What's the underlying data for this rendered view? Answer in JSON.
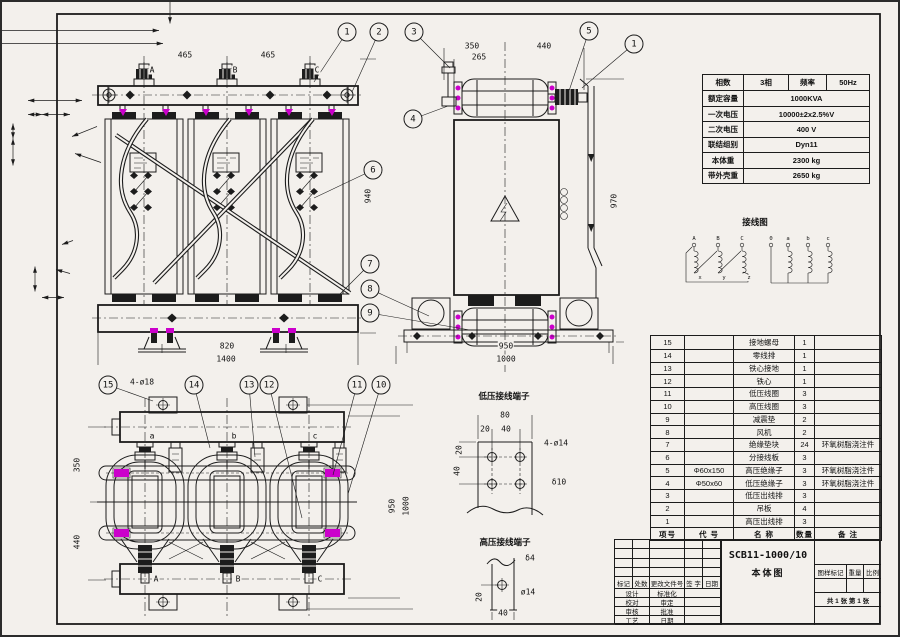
{
  "colors": {
    "paper": "#f3f0ec",
    "line": "#1c1c1c",
    "highlight_magenta": "#cb00cb"
  },
  "spec": {
    "row0": [
      "相数",
      "3相",
      "频率",
      "50Hz"
    ],
    "rows": [
      {
        "label": "额定容量",
        "value": "1000KVA"
      },
      {
        "label": "一次电压",
        "value": "10000±2x2.5%V"
      },
      {
        "label": "二次电压",
        "value": "400 V"
      },
      {
        "label": "联结组别",
        "value": "Dyn11"
      },
      {
        "label": "本体重",
        "value": "2300 kg"
      },
      {
        "label": "带外壳重",
        "value": "2650 kg"
      }
    ]
  },
  "parts": {
    "header": {
      "no": "项号",
      "code": "代 号",
      "name": "名 称",
      "qty": "数量",
      "remark": "备 注"
    },
    "rows": [
      {
        "no": "15",
        "code": "",
        "name": "接地螺母",
        "qty": "1",
        "remark": ""
      },
      {
        "no": "14",
        "code": "",
        "name": "零线排",
        "qty": "1",
        "remark": ""
      },
      {
        "no": "13",
        "code": "",
        "name": "铁心接地",
        "qty": "1",
        "remark": ""
      },
      {
        "no": "12",
        "code": "",
        "name": "铁心",
        "qty": "1",
        "remark": ""
      },
      {
        "no": "11",
        "code": "",
        "name": "低压线圈",
        "qty": "3",
        "remark": ""
      },
      {
        "no": "10",
        "code": "",
        "name": "高压线圈",
        "qty": "3",
        "remark": ""
      },
      {
        "no": "9",
        "code": "",
        "name": "减震垫",
        "qty": "2",
        "remark": ""
      },
      {
        "no": "8",
        "code": "",
        "name": "风机",
        "qty": "2",
        "remark": ""
      },
      {
        "no": "7",
        "code": "",
        "name": "绝缘垫块",
        "qty": "24",
        "remark": "环氧树脂浇注件"
      },
      {
        "no": "6",
        "code": "",
        "name": "分接线板",
        "qty": "3",
        "remark": ""
      },
      {
        "no": "5",
        "code": "Φ60x150",
        "name": "高压绝缘子",
        "qty": "3",
        "remark": "环氧树脂浇注件"
      },
      {
        "no": "4",
        "code": "Φ50x60",
        "name": "低压绝缘子",
        "qty": "3",
        "remark": "环氧树脂浇注件"
      },
      {
        "no": "3",
        "code": "",
        "name": "低压出线排",
        "qty": "3",
        "remark": ""
      },
      {
        "no": "2",
        "code": "",
        "name": "吊板",
        "qty": "4",
        "remark": ""
      },
      {
        "no": "1",
        "code": "",
        "name": "高压出线排",
        "qty": "3",
        "remark": ""
      }
    ]
  },
  "tb": {
    "product": "SCB11-1000/10",
    "drawing_name": "本体图",
    "cols": {
      "mark": "标记",
      "count": "处数",
      "doc": "更改文件号",
      "sign": "签 字",
      "date": "日期"
    },
    "left_rows": [
      [
        "设计",
        "标准化"
      ],
      [
        "校对",
        "审定"
      ],
      [
        "审核",
        "批准"
      ],
      [
        "工艺",
        "日期"
      ]
    ],
    "right": {
      "stamp": "图样标记",
      "weight": "重量",
      "scale": "比例",
      "sheets": "共 1 张 第 1 张"
    }
  },
  "wiring": {
    "title": "接线图",
    "hv_terminals": [
      "A",
      "B",
      "C"
    ],
    "hv_ends": [
      "x",
      "y",
      "z"
    ],
    "lv_terminals": [
      "0",
      "a",
      "b",
      "c"
    ]
  },
  "annotations": {
    "titles": [
      {
        "t": "低压接线端子",
        "x": 502,
        "y": 394,
        "cls": "cn",
        "n": "lv-terminal-detail-title"
      },
      {
        "t": "高压接线端子",
        "x": 503,
        "y": 540,
        "cls": "cn",
        "n": "hv-terminal-detail-title"
      },
      {
        "t": "接线图",
        "x": 753,
        "y": 220,
        "cls": "cn",
        "n": "wiring-diagram-title"
      }
    ],
    "dims": [
      {
        "t": "465",
        "x": 183,
        "y": 53
      },
      {
        "t": "465",
        "x": 266,
        "y": 53
      },
      {
        "t": "A",
        "x": 150,
        "y": 68
      },
      {
        "t": "B",
        "x": 233,
        "y": 68
      },
      {
        "t": "C",
        "x": 315,
        "y": 68
      },
      {
        "t": "820",
        "x": 225,
        "y": 344
      },
      {
        "t": "1400",
        "x": 224,
        "y": 357
      },
      {
        "t": "940",
        "x": 366,
        "y": 194,
        "r": 1
      },
      {
        "t": "350",
        "x": 470,
        "y": 44
      },
      {
        "t": "440",
        "x": 542,
        "y": 44
      },
      {
        "t": "265",
        "x": 477,
        "y": 55
      },
      {
        "t": "950",
        "x": 504,
        "y": 344
      },
      {
        "t": "1000",
        "x": 504,
        "y": 357
      },
      {
        "t": "970",
        "x": 612,
        "y": 199,
        "r": 1
      },
      {
        "t": "4-ø18",
        "x": 140,
        "y": 380
      },
      {
        "t": "a",
        "x": 150,
        "y": 434
      },
      {
        "t": "b",
        "x": 232,
        "y": 434
      },
      {
        "t": "c",
        "x": 313,
        "y": 434
      },
      {
        "t": "A",
        "x": 154,
        "y": 577
      },
      {
        "t": "B",
        "x": 236,
        "y": 577
      },
      {
        "t": "C",
        "x": 318,
        "y": 577
      },
      {
        "t": "350",
        "x": 75,
        "y": 463,
        "r": 1
      },
      {
        "t": "440",
        "x": 75,
        "y": 540,
        "r": 1
      },
      {
        "t": "950",
        "x": 390,
        "y": 504,
        "r": 1
      },
      {
        "t": "1000",
        "x": 404,
        "y": 504,
        "r": 1
      },
      {
        "t": "80",
        "x": 503,
        "y": 413
      },
      {
        "t": "20",
        "x": 483,
        "y": 427
      },
      {
        "t": "40",
        "x": 504,
        "y": 427
      },
      {
        "t": "20",
        "x": 457,
        "y": 448,
        "r": 1
      },
      {
        "t": "40",
        "x": 455,
        "y": 469,
        "r": 1
      },
      {
        "t": "4-ø14",
        "x": 554,
        "y": 441
      },
      {
        "t": "δ10",
        "x": 557,
        "y": 480
      },
      {
        "t": "δ4",
        "x": 528,
        "y": 556
      },
      {
        "t": "ø14",
        "x": 526,
        "y": 590
      },
      {
        "t": "20",
        "x": 477,
        "y": 595,
        "r": 1
      },
      {
        "t": "40",
        "x": 501,
        "y": 611
      },
      {
        "t": "A",
        "x": 692,
        "y": 237,
        "s": 5.5
      },
      {
        "t": "B",
        "x": 716,
        "y": 237,
        "s": 5.5
      },
      {
        "t": "C",
        "x": 740,
        "y": 237,
        "s": 5.5
      },
      {
        "t": "x",
        "x": 698,
        "y": 276,
        "s": 5.5
      },
      {
        "t": "y",
        "x": 722,
        "y": 276,
        "s": 5.5
      },
      {
        "t": "z",
        "x": 747,
        "y": 276,
        "s": 5.5
      },
      {
        "t": "0",
        "x": 769,
        "y": 237,
        "s": 5.5
      },
      {
        "t": "a",
        "x": 786,
        "y": 237,
        "s": 5.5
      },
      {
        "t": "b",
        "x": 806,
        "y": 237,
        "s": 5.5
      },
      {
        "t": "c",
        "x": 826,
        "y": 237,
        "s": 5.5
      }
    ],
    "balloons": [
      {
        "n": "1",
        "x": 345,
        "y": 30,
        "lx": 312,
        "ly": 80
      },
      {
        "n": "2",
        "x": 377,
        "y": 30,
        "lx": 350,
        "ly": 90
      },
      {
        "n": "6",
        "x": 371,
        "y": 168,
        "lx": 312,
        "ly": 196
      },
      {
        "n": "7",
        "x": 368,
        "y": 262,
        "lx": 338,
        "ly": 292
      },
      {
        "n": "8",
        "x": 368,
        "y": 287,
        "lx": 427,
        "ly": 314
      },
      {
        "n": "9",
        "x": 368,
        "y": 311,
        "lx": 468,
        "ly": 328
      },
      {
        "n": "3",
        "x": 412,
        "y": 30,
        "lx": 448,
        "ly": 66
      },
      {
        "n": "4",
        "x": 411,
        "y": 117,
        "lx": 446,
        "ly": 104
      },
      {
        "n": "5",
        "x": 587,
        "y": 29,
        "lx": 566,
        "ly": 92
      },
      {
        "n": "1",
        "x": 632,
        "y": 42,
        "lx": 580,
        "ly": 86
      },
      {
        "n": "15",
        "x": 106,
        "y": 383,
        "lx": 151,
        "ly": 399
      },
      {
        "n": "14",
        "x": 192,
        "y": 383,
        "lx": 208,
        "ly": 446
      },
      {
        "n": "13",
        "x": 247,
        "y": 383,
        "lx": 253,
        "ly": 455
      },
      {
        "n": "12",
        "x": 267,
        "y": 383,
        "lx": 300,
        "ly": 516
      },
      {
        "n": "11",
        "x": 355,
        "y": 383,
        "lx": 331,
        "ly": 473
      },
      {
        "n": "10",
        "x": 379,
        "y": 383,
        "lx": 346,
        "ly": 492
      }
    ]
  }
}
